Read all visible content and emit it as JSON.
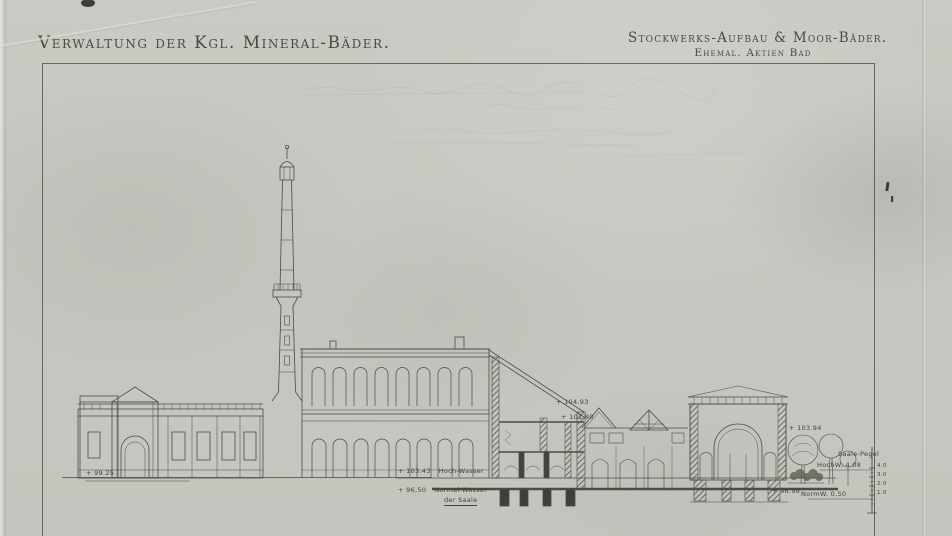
{
  "titles": {
    "left": "Verwaltung der Kgl. Mineral-Bäder.",
    "right_main": "Stockwerks-Aufbau & Moor-Bäder.",
    "right_sub": "Ehemal. Aktien Bad"
  },
  "levels": {
    "ground_left": "+ 99.25",
    "hochwasser_value": "+ 103.43",
    "hochwasser_label": "Hoch-Wasser",
    "normalwasser_value": "+ 96,50",
    "normalwasser_label": "Normal-Wasser",
    "normalwasser_sub": "der Saale",
    "section_upper": "+ 104.93",
    "section_lower": "+ 101.80",
    "pavilion_cornice": "+ 103.94",
    "ground_right": "+ 96.98"
  },
  "pegel": {
    "title": "Saale-Pegel",
    "hochwasser": "HochW. 4.08",
    "normalwasser": "NormW. 0,50",
    "ticks": [
      "4.0",
      "3.0",
      "2.0",
      "1.0"
    ]
  },
  "colors": {
    "paper": "#c6c8c1",
    "ink": "#45463f",
    "ink_faint": "#9a9c90"
  }
}
